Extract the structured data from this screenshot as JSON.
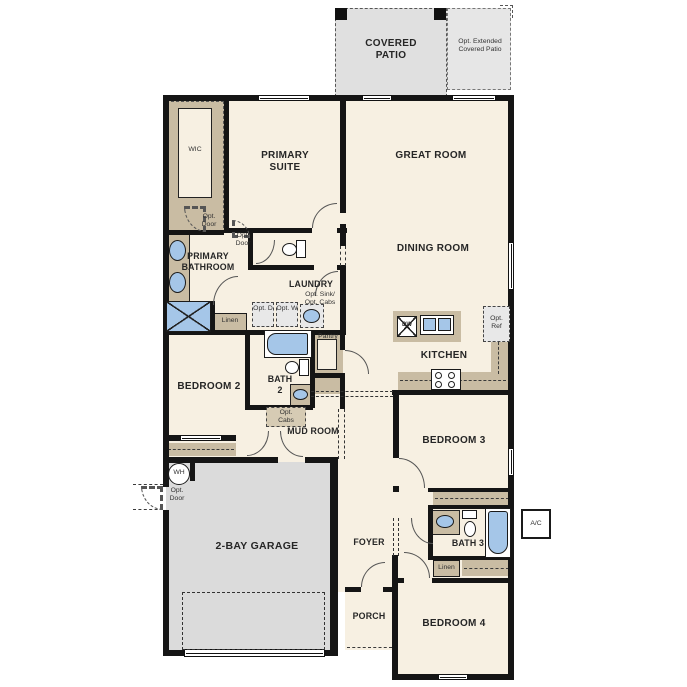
{
  "patio": {
    "covered": "COVERED PATIO",
    "extended": "Opt. Extended Covered Patio"
  },
  "rooms": {
    "wic": "WIC",
    "primary_suite": "PRIMARY SUITE",
    "great_room": "GREAT ROOM",
    "dining_room": "DINING ROOM",
    "primary_bathroom": "PRIMARY BATHROOM",
    "laundry": "LAUNDRY",
    "kitchen": "KITCHEN",
    "bedroom2": "BEDROOM 2",
    "bath2": "BATH 2",
    "mud_room": "MUD ROOM",
    "garage": "2-BAY GARAGE",
    "foyer": "FOYER",
    "porch": "PORCH",
    "bedroom3": "BEDROOM 3",
    "bath3": "BATH 3",
    "bedroom4": "BEDROOM 4"
  },
  "closets": {
    "linen1": "Linen",
    "linen2": "Linen",
    "pantry": "Pantry"
  },
  "options": {
    "opt_ref": "Opt. Ref",
    "opt_sink_cabs": "Opt. Sink/ Opt. Cabs",
    "opt_d": "Opt. D",
    "opt_w": "Opt. W",
    "opt_cabs": "Opt. Cabs",
    "opt_door": "Opt. Door"
  },
  "equipment": {
    "wh": "WH",
    "ac": "A/C",
    "dw": "DW"
  },
  "colors": {
    "wall": "#151515",
    "interior": "#f7f0e2",
    "patio": "#e0e0e0",
    "garage": "#dbdbdb",
    "cabinet": "#c9bca3",
    "fixture": "#a5c6e8"
  }
}
